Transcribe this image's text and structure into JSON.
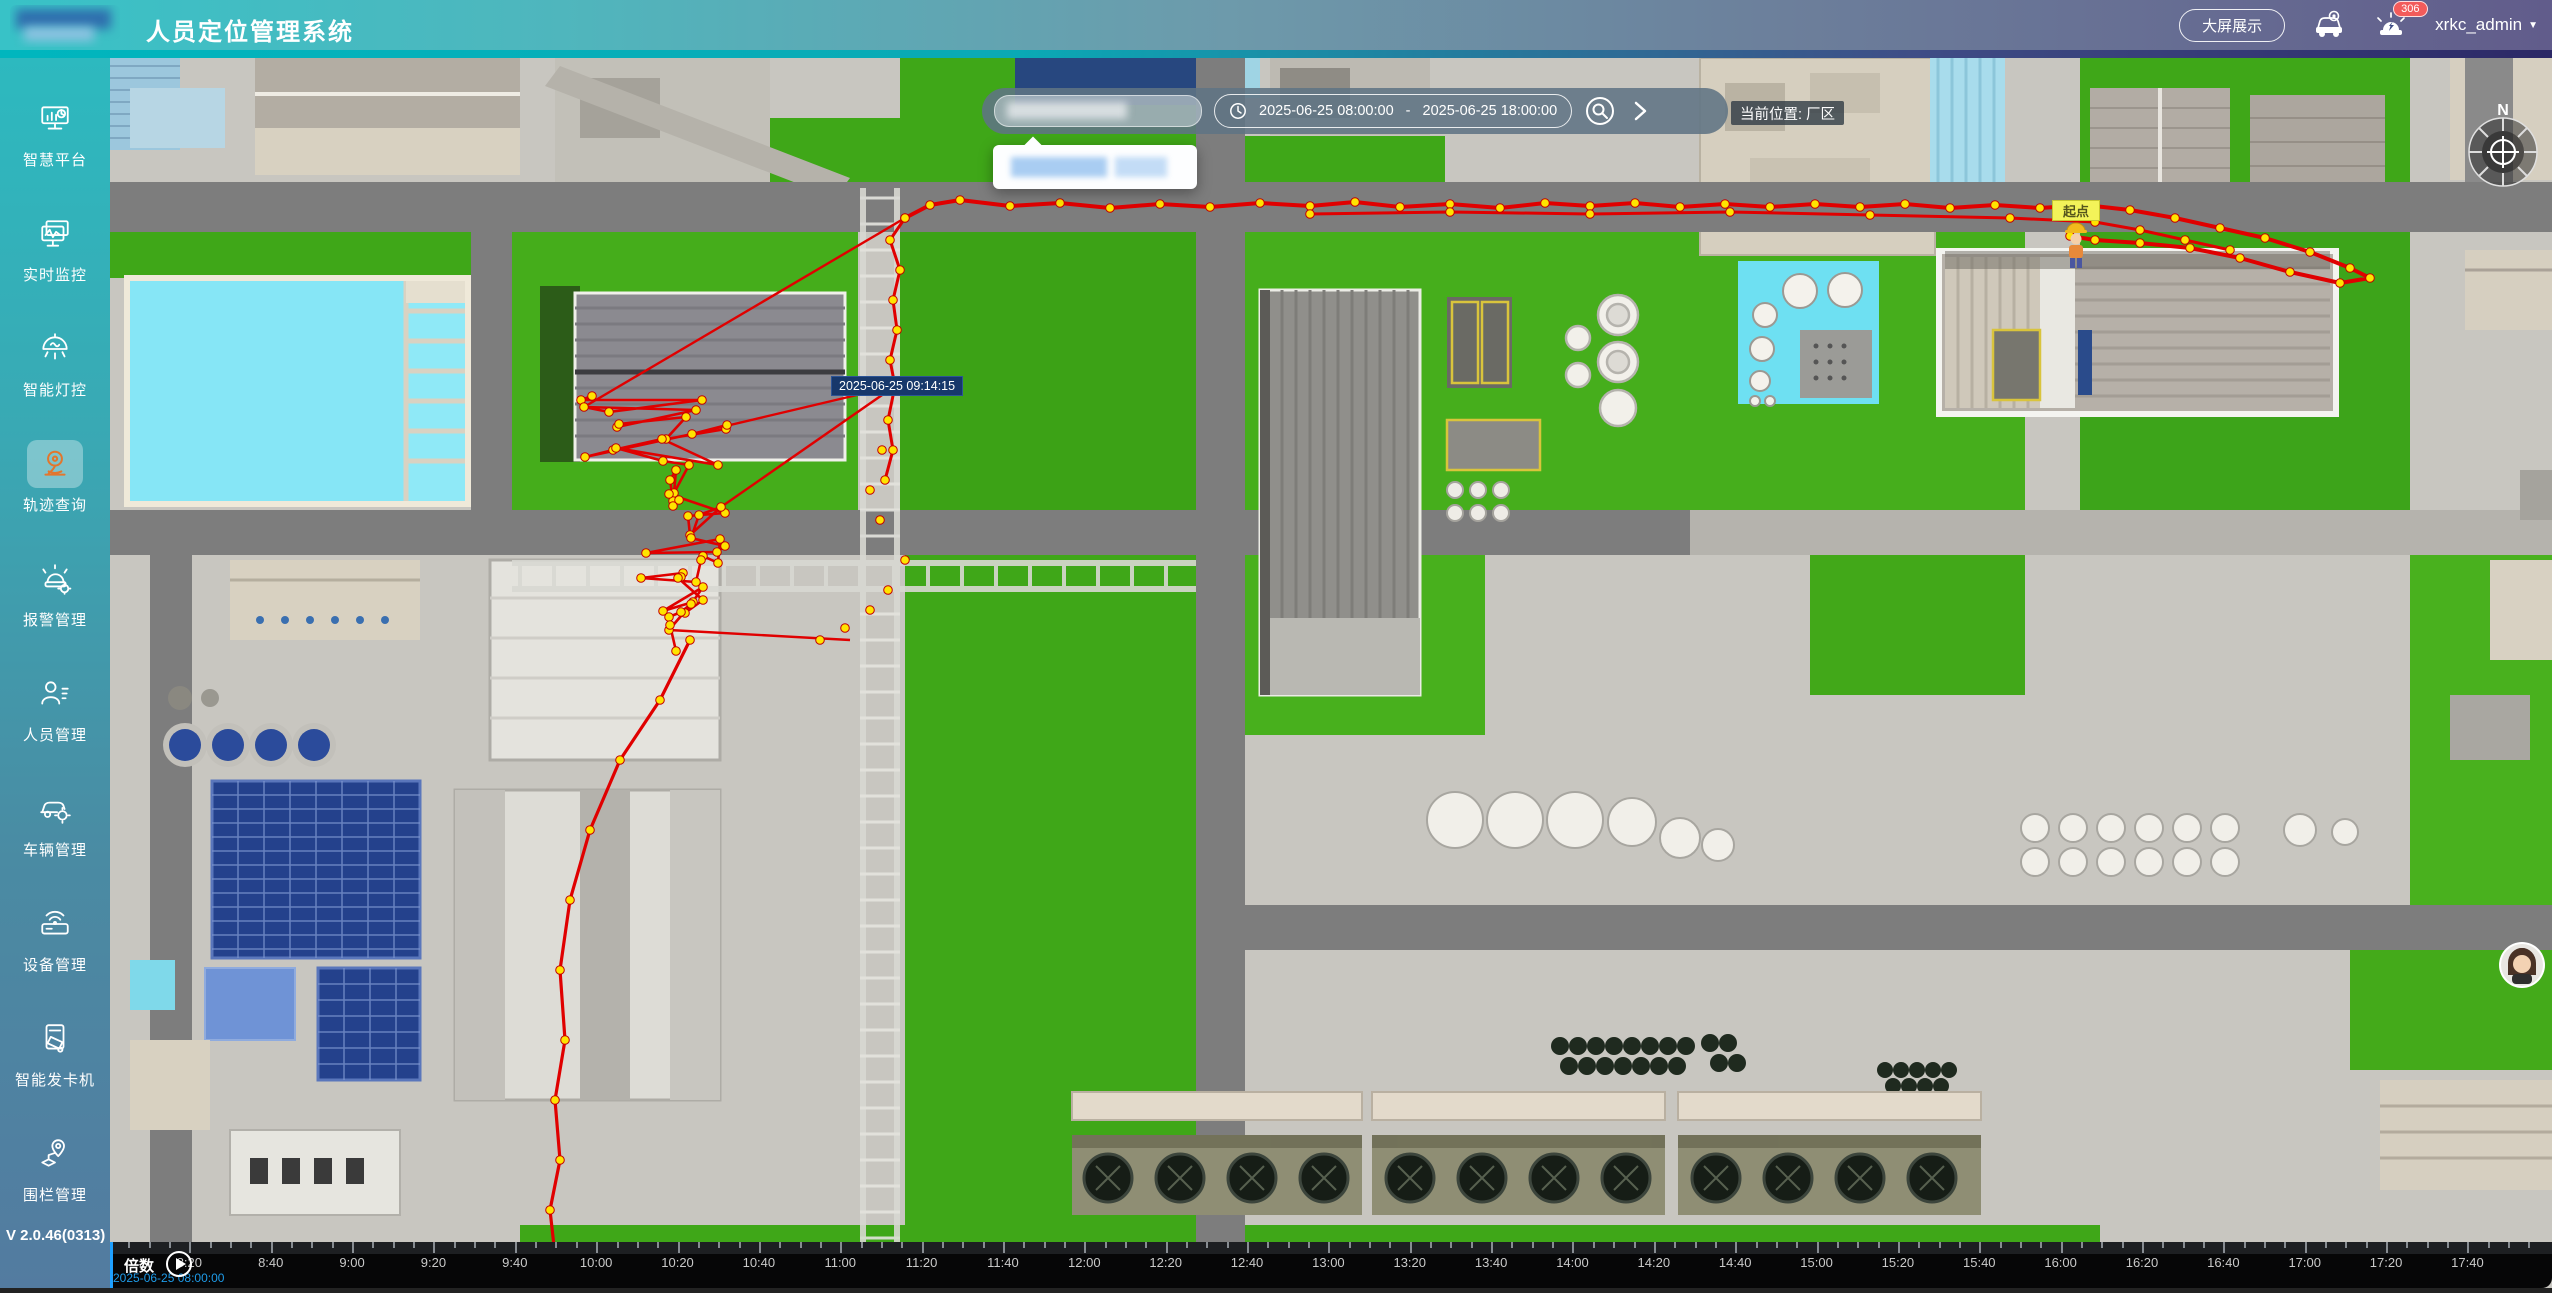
{
  "header": {
    "title": "人员定位管理系统",
    "big_screen_label": "大屏展示",
    "alarm_count": "306",
    "username": "xrkc_admin",
    "caret": "▼"
  },
  "sidebar": {
    "items": [
      {
        "label": "智慧平台",
        "icon": "smart-platform-icon",
        "active": false
      },
      {
        "label": "实时监控",
        "icon": "realtime-monitor-icon",
        "active": false
      },
      {
        "label": "智能灯控",
        "icon": "smart-light-icon",
        "active": false
      },
      {
        "label": "轨迹查询",
        "icon": "track-query-icon",
        "active": true
      },
      {
        "label": "报警管理",
        "icon": "alarm-manage-icon",
        "active": false
      },
      {
        "label": "人员管理",
        "icon": "person-manage-icon",
        "active": false
      },
      {
        "label": "车辆管理",
        "icon": "vehicle-manage-icon",
        "active": false
      },
      {
        "label": "设备管理",
        "icon": "device-manage-icon",
        "active": false
      },
      {
        "label": "智能发卡机",
        "icon": "card-machine-icon",
        "active": false
      },
      {
        "label": "围栏管理",
        "icon": "fence-manage-icon",
        "active": false
      }
    ],
    "version": "V 2.0.46(0313)"
  },
  "toolbar": {
    "date_start": "2025-06-25 08:00:00",
    "date_separator": "-",
    "date_end": "2025-06-25 18:00:00",
    "location_label": "当前位置: 厂区"
  },
  "map": {
    "tooltip_time": "2025-06-25 09:14:15",
    "start_point_label": "起点",
    "compass_north": "N",
    "accent_track_color": "#e00000",
    "track_dot_color": "#ffe400"
  },
  "timeline": {
    "speed_label": "倍数",
    "current_time": "2025-06-25 08:00:00",
    "tick_labels": [
      "8:20",
      "8:40",
      "9:00",
      "9:20",
      "9:40",
      "10:00",
      "10:20",
      "10:40",
      "11:00",
      "11:20",
      "11:40",
      "12:00",
      "12:20",
      "12:40",
      "13:00",
      "13:20",
      "13:40",
      "14:00",
      "14:20",
      "14:40",
      "15:00",
      "15:20",
      "15:40",
      "16:00",
      "16:20",
      "16:40",
      "17:00",
      "17:20",
      "17:40"
    ]
  }
}
